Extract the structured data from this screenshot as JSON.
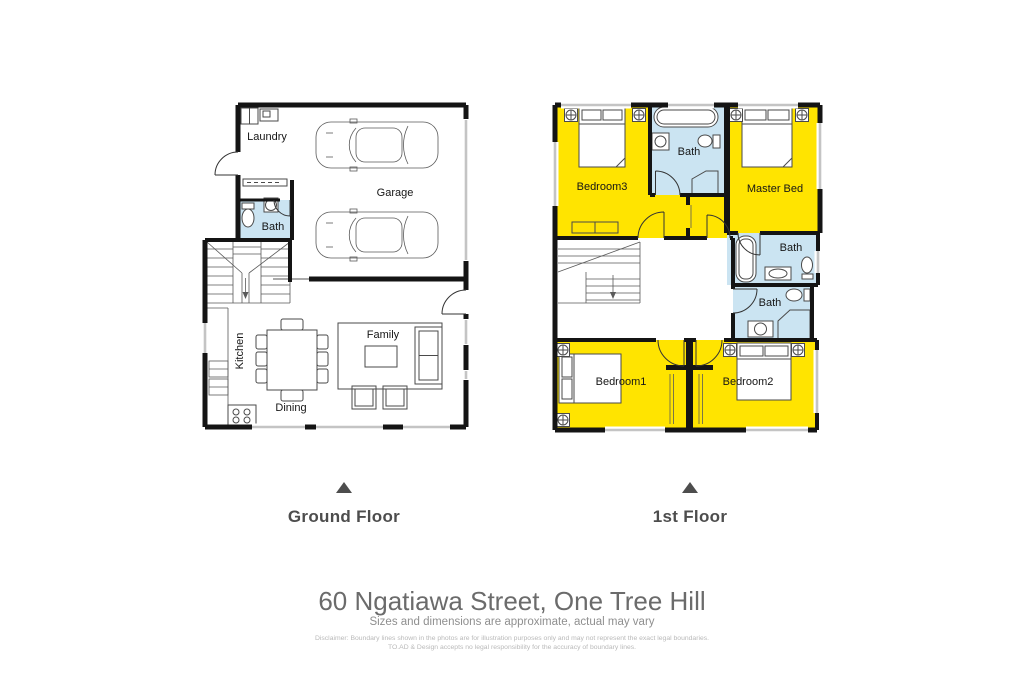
{
  "colors": {
    "room_yellow": "#FFE400",
    "room_blue": "#CBE4F2",
    "wall": "#141414",
    "window_gray": "#C4C4C4",
    "caption_gray": "#4D4D4D",
    "address_gray": "#6B6B6B",
    "subtitle_gray": "#8F8F8F",
    "disclaimer_gray": "#B9B9B9"
  },
  "ground_floor": {
    "label": "Ground Floor",
    "rooms": {
      "laundry": "Laundry",
      "garage": "Garage",
      "bath": "Bath",
      "kitchen": "Kitchen",
      "dining": "Dining",
      "family": "Family"
    }
  },
  "first_floor": {
    "label": "1st Floor",
    "rooms": {
      "bedroom3": "Bedroom3",
      "bath_top": "Bath",
      "master": "Master Bed",
      "bath_mid": "Bath",
      "bath_low": "Bath",
      "bedroom1": "Bedroom1",
      "bedroom2": "Bedroom2"
    }
  },
  "footer": {
    "address": "60 Ngatiawa Street, One Tree Hill",
    "subtitle": "Sizes and dimensions are approximate, actual may vary",
    "disclaimer_line1": "Disclaimer: Boundary lines shown in the photos are for illustration purposes only and may not represent the exact legal boundaries.",
    "disclaimer_line2": "TO.AD & Design accepts no legal responsibility for the accuracy of boundary lines."
  }
}
